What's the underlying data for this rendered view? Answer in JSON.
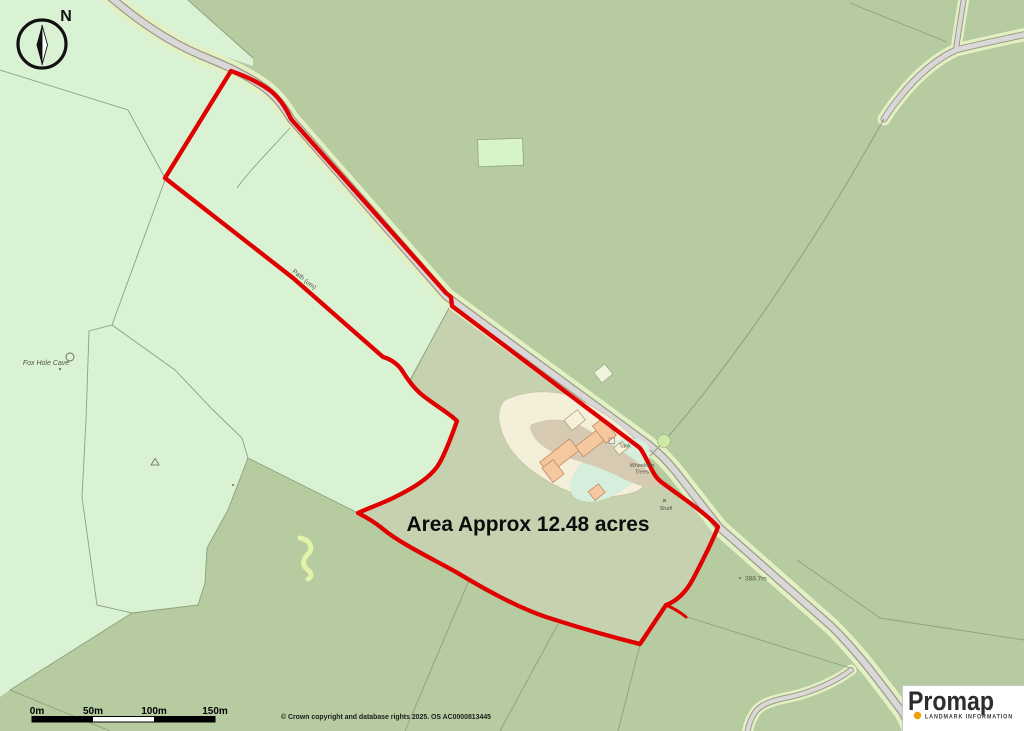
{
  "map": {
    "compass_north": "N",
    "area_label": "Area Approx 12.48 acres",
    "labels": {
      "fox_hole_cave": "Fox Hole Cave",
      "path_um": "Path (um)",
      "tank": "Tank",
      "wheeldon_line1": "Wheeldon",
      "wheeldon_line2": "Trees",
      "shaft": "Shaft",
      "spot_height": "388.7m"
    },
    "scale_bar": {
      "ticks": [
        "0m",
        "50m",
        "100m",
        "150m"
      ]
    },
    "copyright": "© Crown copyright and database rights 2025. OS AC0000813445",
    "logo": {
      "brand": "Promap",
      "subtitle": "LANDMARK INFORMATION"
    },
    "colors": {
      "boundary_red": "#e10000",
      "logo_orange": "#f2a007"
    }
  }
}
